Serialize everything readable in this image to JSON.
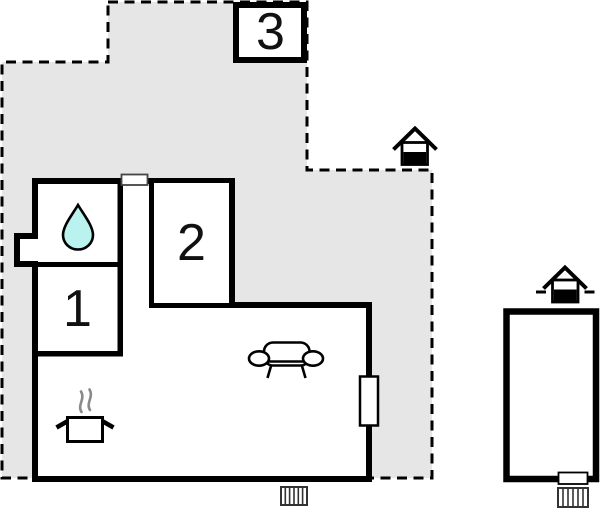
{
  "image": {
    "kind": "floor-plan",
    "width": 600,
    "height": 512
  },
  "floorplan": {
    "plot": {
      "boundary_style": "dashed",
      "fill": "#e6e6e6",
      "line_color": "#000000"
    },
    "building": {
      "wall_color": "#000000",
      "fill": "#ffffff"
    },
    "rooms": [
      {
        "label": "1"
      },
      {
        "label": "2"
      },
      {
        "label": "3"
      }
    ],
    "icons": {
      "water_drop": {
        "name": "water-drop-icon",
        "fill": "#b9f2ef",
        "meaning": "bathroom"
      },
      "sofa": {
        "name": "sofa-icon",
        "meaning": "living room"
      },
      "cooking_pot": {
        "name": "cooking-pot-icon",
        "steam_color": "#8a8a8a",
        "meaning": "kitchen"
      },
      "radiator_main": {
        "name": "radiator-icon"
      },
      "radiator_annex": {
        "name": "radiator-icon"
      },
      "house_marker_plot": {
        "name": "house-marker-icon"
      },
      "house_marker_annex": {
        "name": "house-marker-icon"
      },
      "window_main": {
        "name": "window-icon"
      },
      "door_main": {
        "name": "door-icon"
      },
      "door_annex": {
        "name": "door-icon"
      }
    }
  }
}
